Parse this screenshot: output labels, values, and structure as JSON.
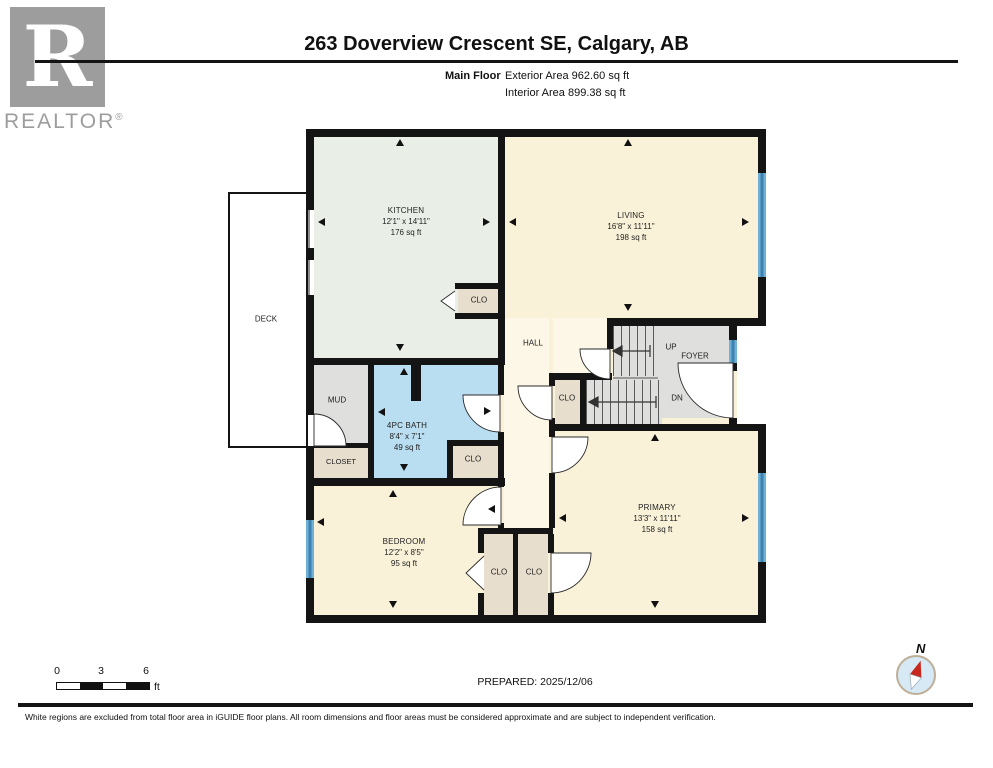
{
  "header": {
    "logo_letter": "R",
    "logo_name": "REALTOR",
    "logo_reg": "®",
    "title": "263 Doverview Crescent SE, Calgary, AB",
    "floor_label": "Main Floor",
    "exterior_area": "Exterior Area 962.60 sq ft",
    "interior_area": "Interior Area 899.38 sq ft"
  },
  "rooms": {
    "kitchen": {
      "name": "KITCHEN",
      "dims": "12'1\" x 14'11\"",
      "area": "176 sq ft"
    },
    "living": {
      "name": "LIVING",
      "dims": "16'8\" x 11'11\"",
      "area": "198 sq ft"
    },
    "bath": {
      "name": "4PC BATH",
      "dims": "8'4\" x 7'1\"",
      "area": "49 sq ft"
    },
    "bedroom": {
      "name": "BEDROOM",
      "dims": "12'2\" x 8'5\"",
      "area": "95 sq ft"
    },
    "primary": {
      "name": "PRIMARY",
      "dims": "13'3\" x 11'11\"",
      "area": "158 sq ft"
    },
    "deck": "DECK",
    "hall": "HALL",
    "foyer": "FOYER",
    "mud": "MUD",
    "closet": "CLOSET",
    "clo": "CLO",
    "up": "UP",
    "dn": "DN"
  },
  "scale_bar": {
    "tick0": "0",
    "tick3": "3",
    "tick6": "6",
    "unit": "ft"
  },
  "prepared": "PREPARED: 2025/12/06",
  "compass": {
    "north": "N"
  },
  "footer": {
    "disclaimer": "White regions are excluded from total floor area in iGUIDE floor plans. All room dimensions and floor areas must be considered approximate and are subject to independent verification."
  },
  "colors": {
    "wall": "#141414",
    "room_cream": "#faf2d8",
    "hall_cream": "#fcf7e6",
    "kitchen_mint": "#e9efe7",
    "bath_blue": "#b9ddf1",
    "utility_gray": "#dfdfdd",
    "closet_tan": "#e8decd",
    "window_blue": "#6fb0d6",
    "compass_red": "#c8281e",
    "logo_gray": "#9d9d9d"
  }
}
